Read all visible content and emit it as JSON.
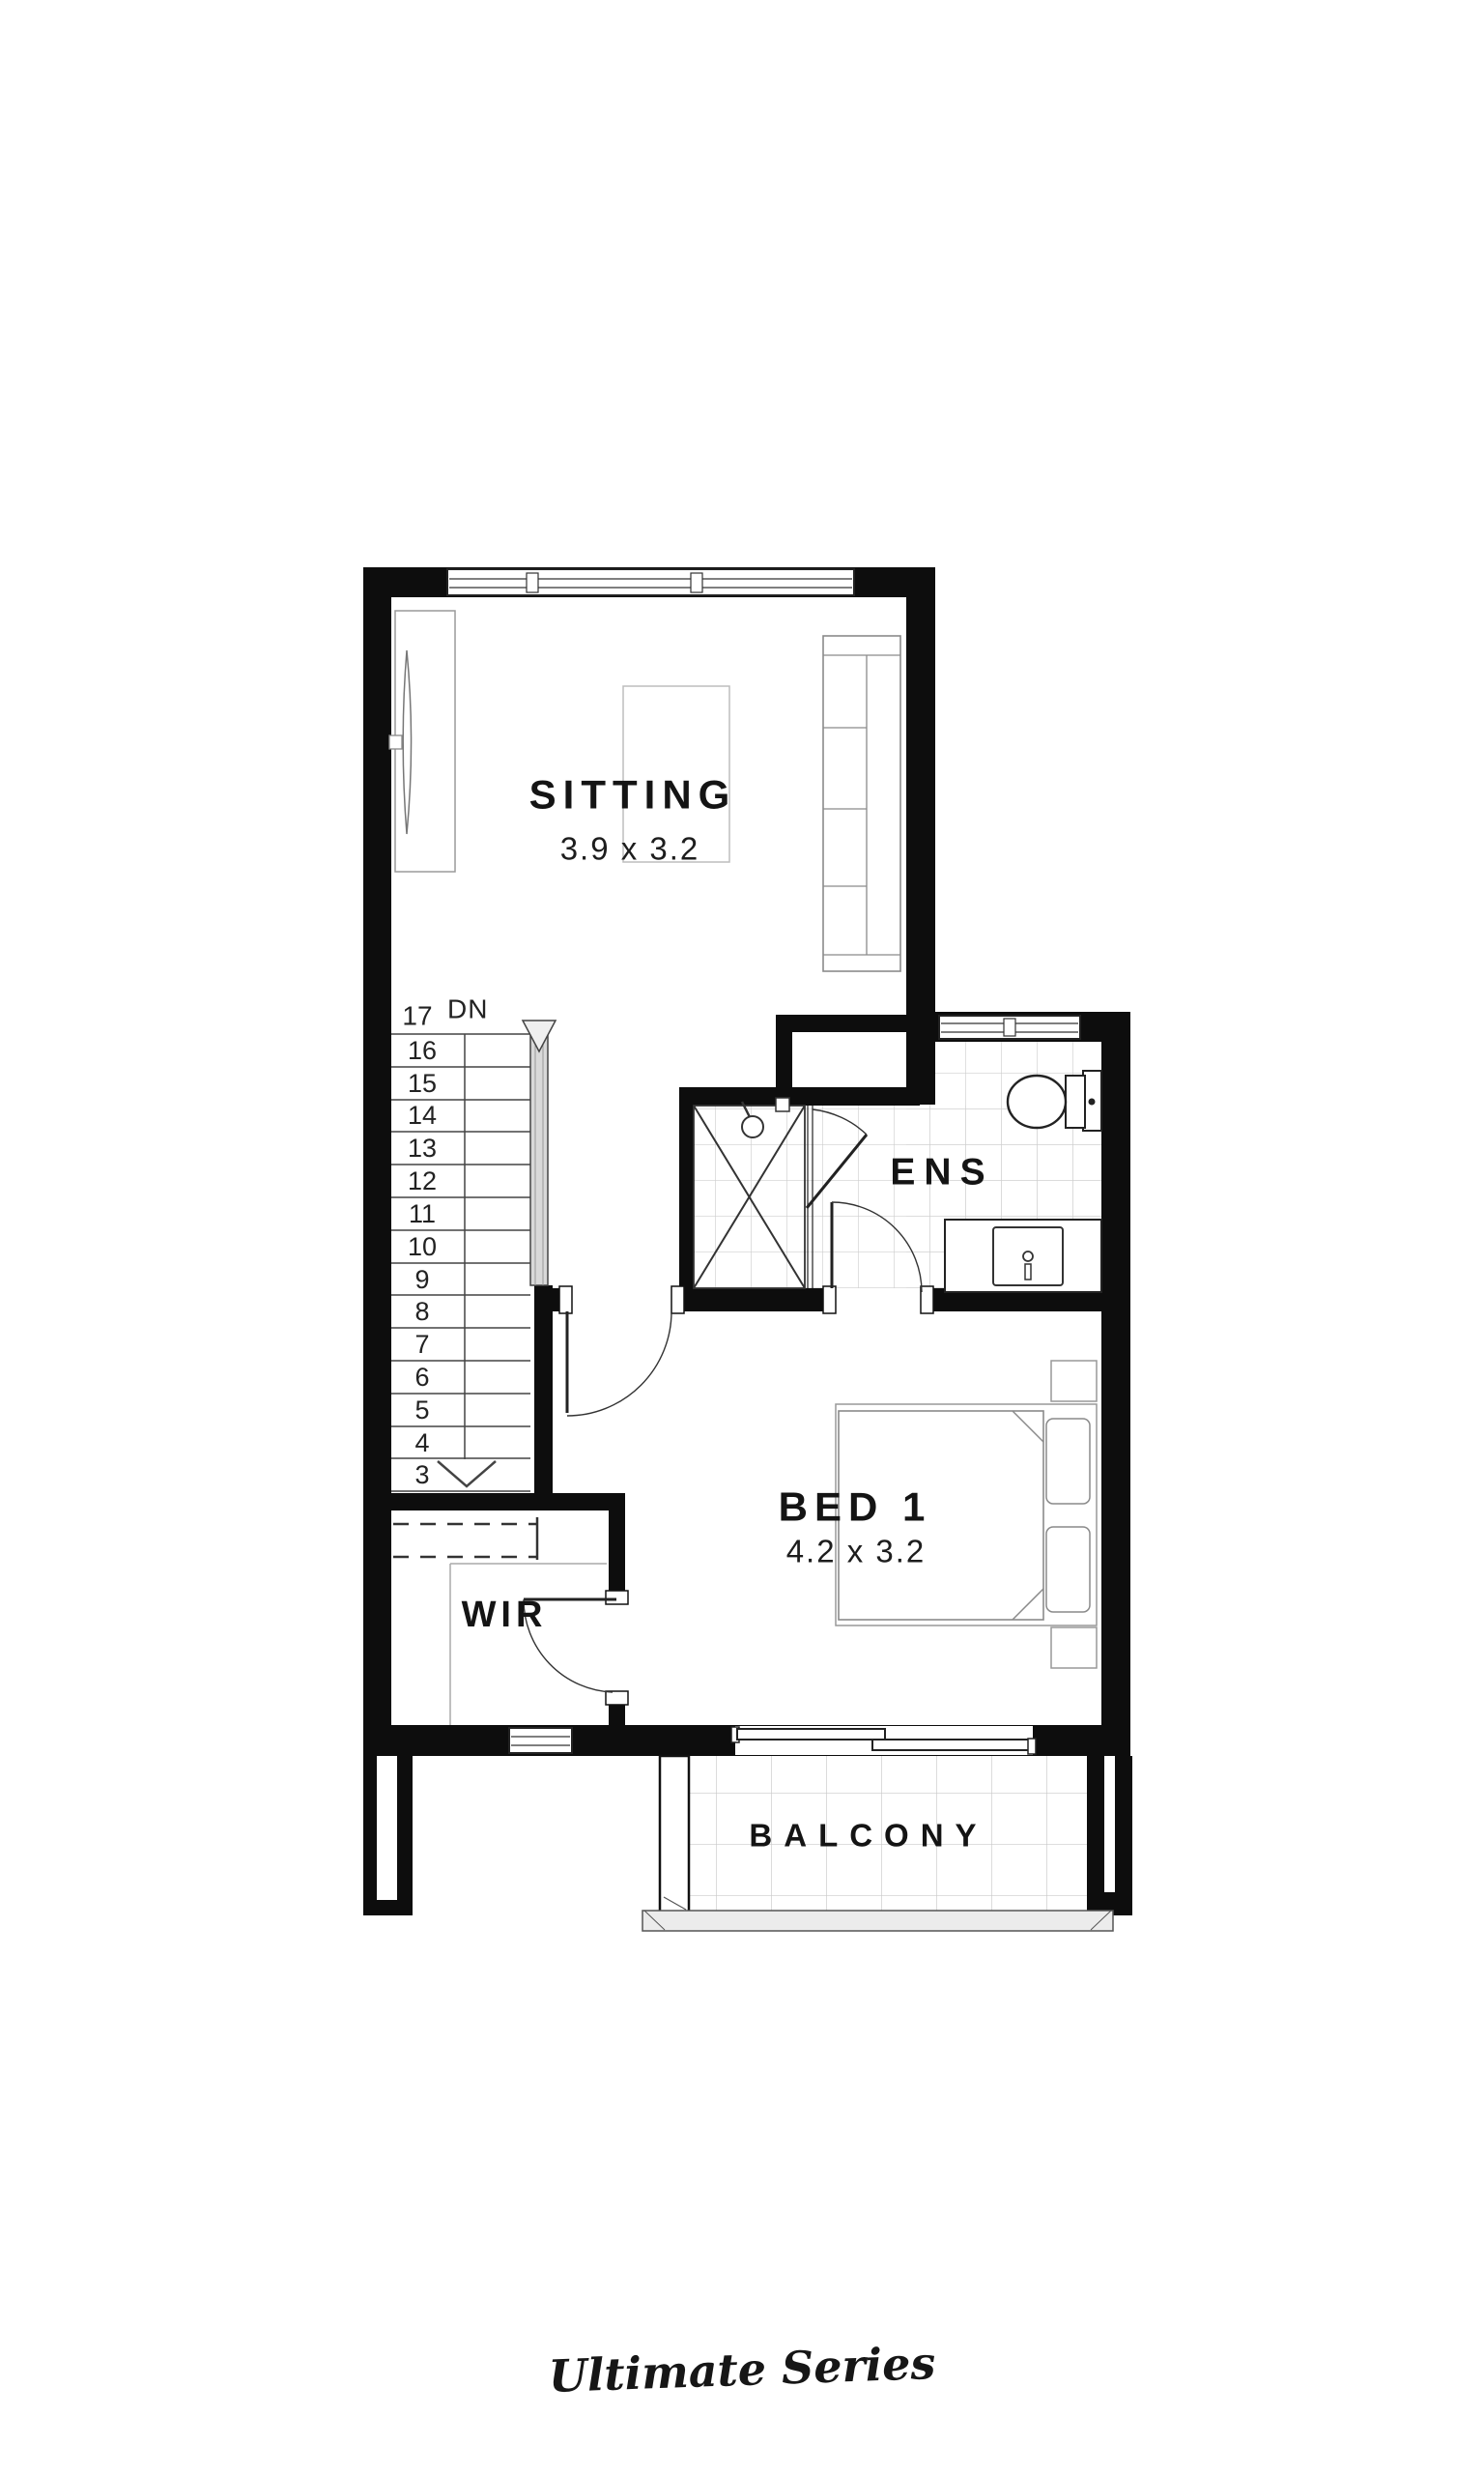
{
  "branding": {
    "series_label": "Ultimate Series"
  },
  "rooms": {
    "sitting": {
      "name": "SITTING",
      "dimensions": "3.9 x 3.2"
    },
    "ensuite": {
      "name": "ENS"
    },
    "bed1": {
      "name": "BED 1",
      "dimensions": "4.2 x 3.2"
    },
    "wir": {
      "name": "WIR"
    },
    "balcony": {
      "name": "BALCONY"
    }
  },
  "stairs": {
    "top_step": "17",
    "direction_label": "DN",
    "steps": [
      "16",
      "15",
      "14",
      "13",
      "12",
      "11",
      "10",
      "9",
      "8",
      "7",
      "6",
      "5",
      "4",
      "3"
    ]
  }
}
